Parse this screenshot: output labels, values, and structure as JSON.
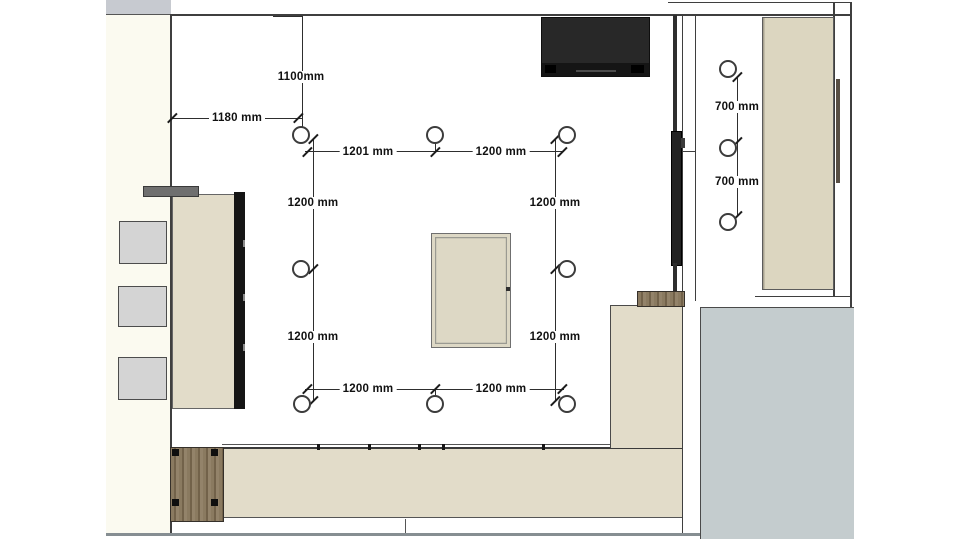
{
  "plan": {
    "dimension_labels": {
      "d1100": "1100mm",
      "d1180": "1180 mm",
      "d1201": "1201 mm",
      "d1200_top_right": "1200 mm",
      "d1200_left_upper": "1200 mm",
      "d1200_right_upper": "1200 mm",
      "d1200_left_lower": "1200 mm",
      "d1200_right_lower": "1200 mm",
      "d1200_bottom_left": "1200 mm",
      "d1200_bottom_right": "1200 mm",
      "d700_upper": "700 mm",
      "d700_lower": "700 mm"
    },
    "colors": {
      "cabinet_beige": "#e2dcc9",
      "panel_beige": "#dcd6c0",
      "table_beige": "#ddd8c5",
      "floor_gray": "#c4ccce",
      "wood_brown": "#84745a",
      "tv_black": "#282828",
      "wall_line": "#3f3f3f",
      "exterior_offwhite": "#fbfaf0",
      "stool_gray": "#d4d4d4"
    },
    "lights_count": 11
  }
}
